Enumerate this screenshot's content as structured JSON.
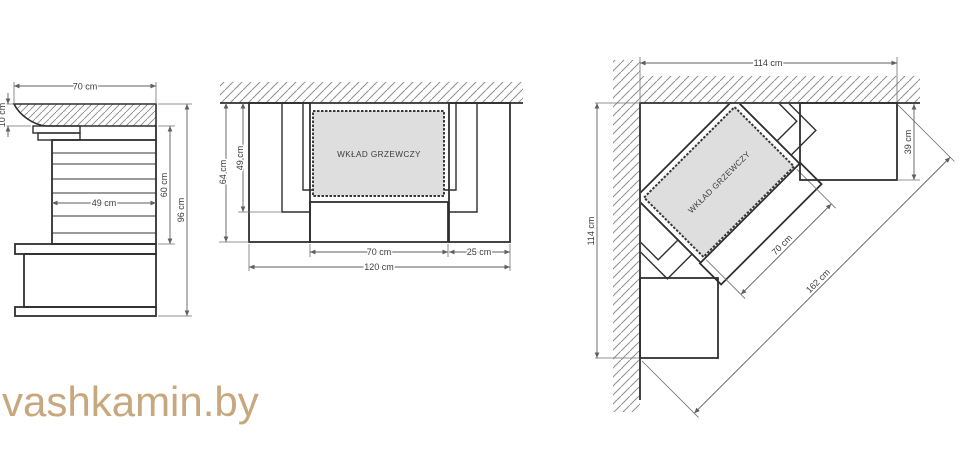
{
  "watermark": "vashkamin.by",
  "colors": {
    "watermark": "#c7a77d",
    "line": "#2f2f2f",
    "dimension": "#5f5f5f",
    "insert_fill": "#dedede",
    "hatch": "#909090"
  },
  "side_view": {
    "dims": {
      "width_top": "70 cm",
      "shelf_thickness": "10 cm",
      "slat_width": "49 cm",
      "inner_height": "60 cm",
      "total_height": "96 cm"
    }
  },
  "front_plan_view": {
    "insert_label": "WKŁAD GRZEWCZY",
    "dims": {
      "depth_total": "64 cm",
      "depth_inner": "49 cm",
      "opening_width": "70 cm",
      "column_width": "25 cm",
      "total_width": "120 cm"
    }
  },
  "corner_plan_view": {
    "insert_label": "WKŁAD GRZEWCZY",
    "dims": {
      "wall_top": "114 cm",
      "wall_left": "114 cm",
      "column_depth": "39 cm",
      "opening_width": "70 cm",
      "front_total": "162 cm"
    }
  }
}
